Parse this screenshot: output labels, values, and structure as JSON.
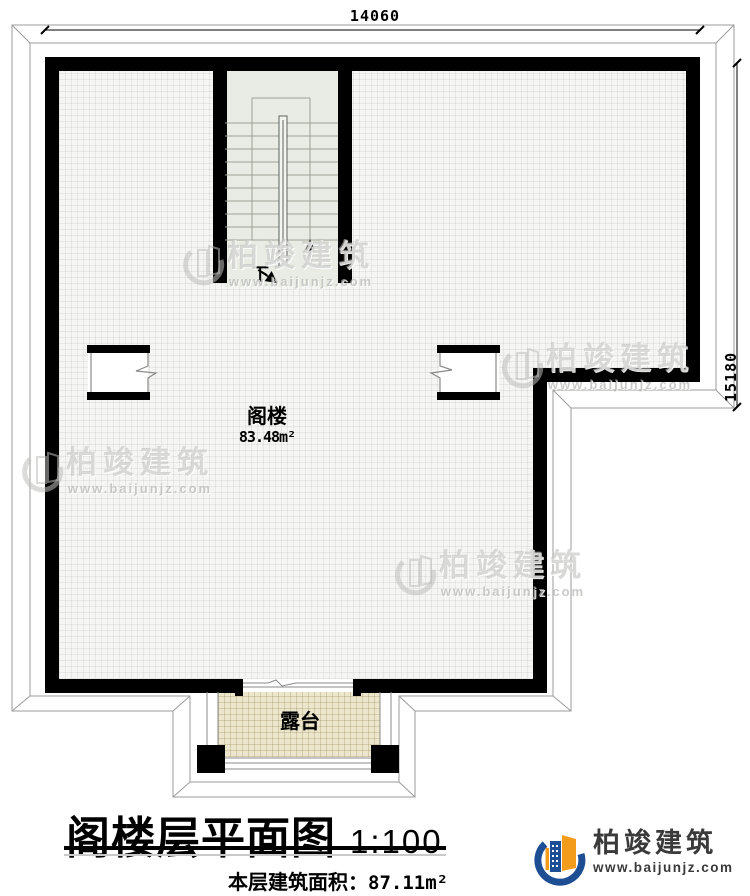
{
  "plan": {
    "dim_top": "14060",
    "dim_right": "15180",
    "stair_down_label": "下",
    "room_name": "阁楼",
    "room_area": "83.48m²",
    "terrace_name": "露台"
  },
  "title_block": {
    "title": "阁楼层平面图",
    "scale": "1:100",
    "area_label": "本层建筑面积：",
    "area_value": "87.11m²"
  },
  "branding": {
    "watermark_name": "柏竣建筑",
    "watermark_url": "www.baijunjz.com",
    "logo_name": "柏竣建筑",
    "logo_url": "www.baijunjz.com"
  },
  "colors": {
    "wall": "#000000",
    "logo_blue": "#1d4e94",
    "logo_orange": "#f39c1c",
    "floor": "#f5f5f3",
    "terrace_floor": "#ece6cd"
  }
}
